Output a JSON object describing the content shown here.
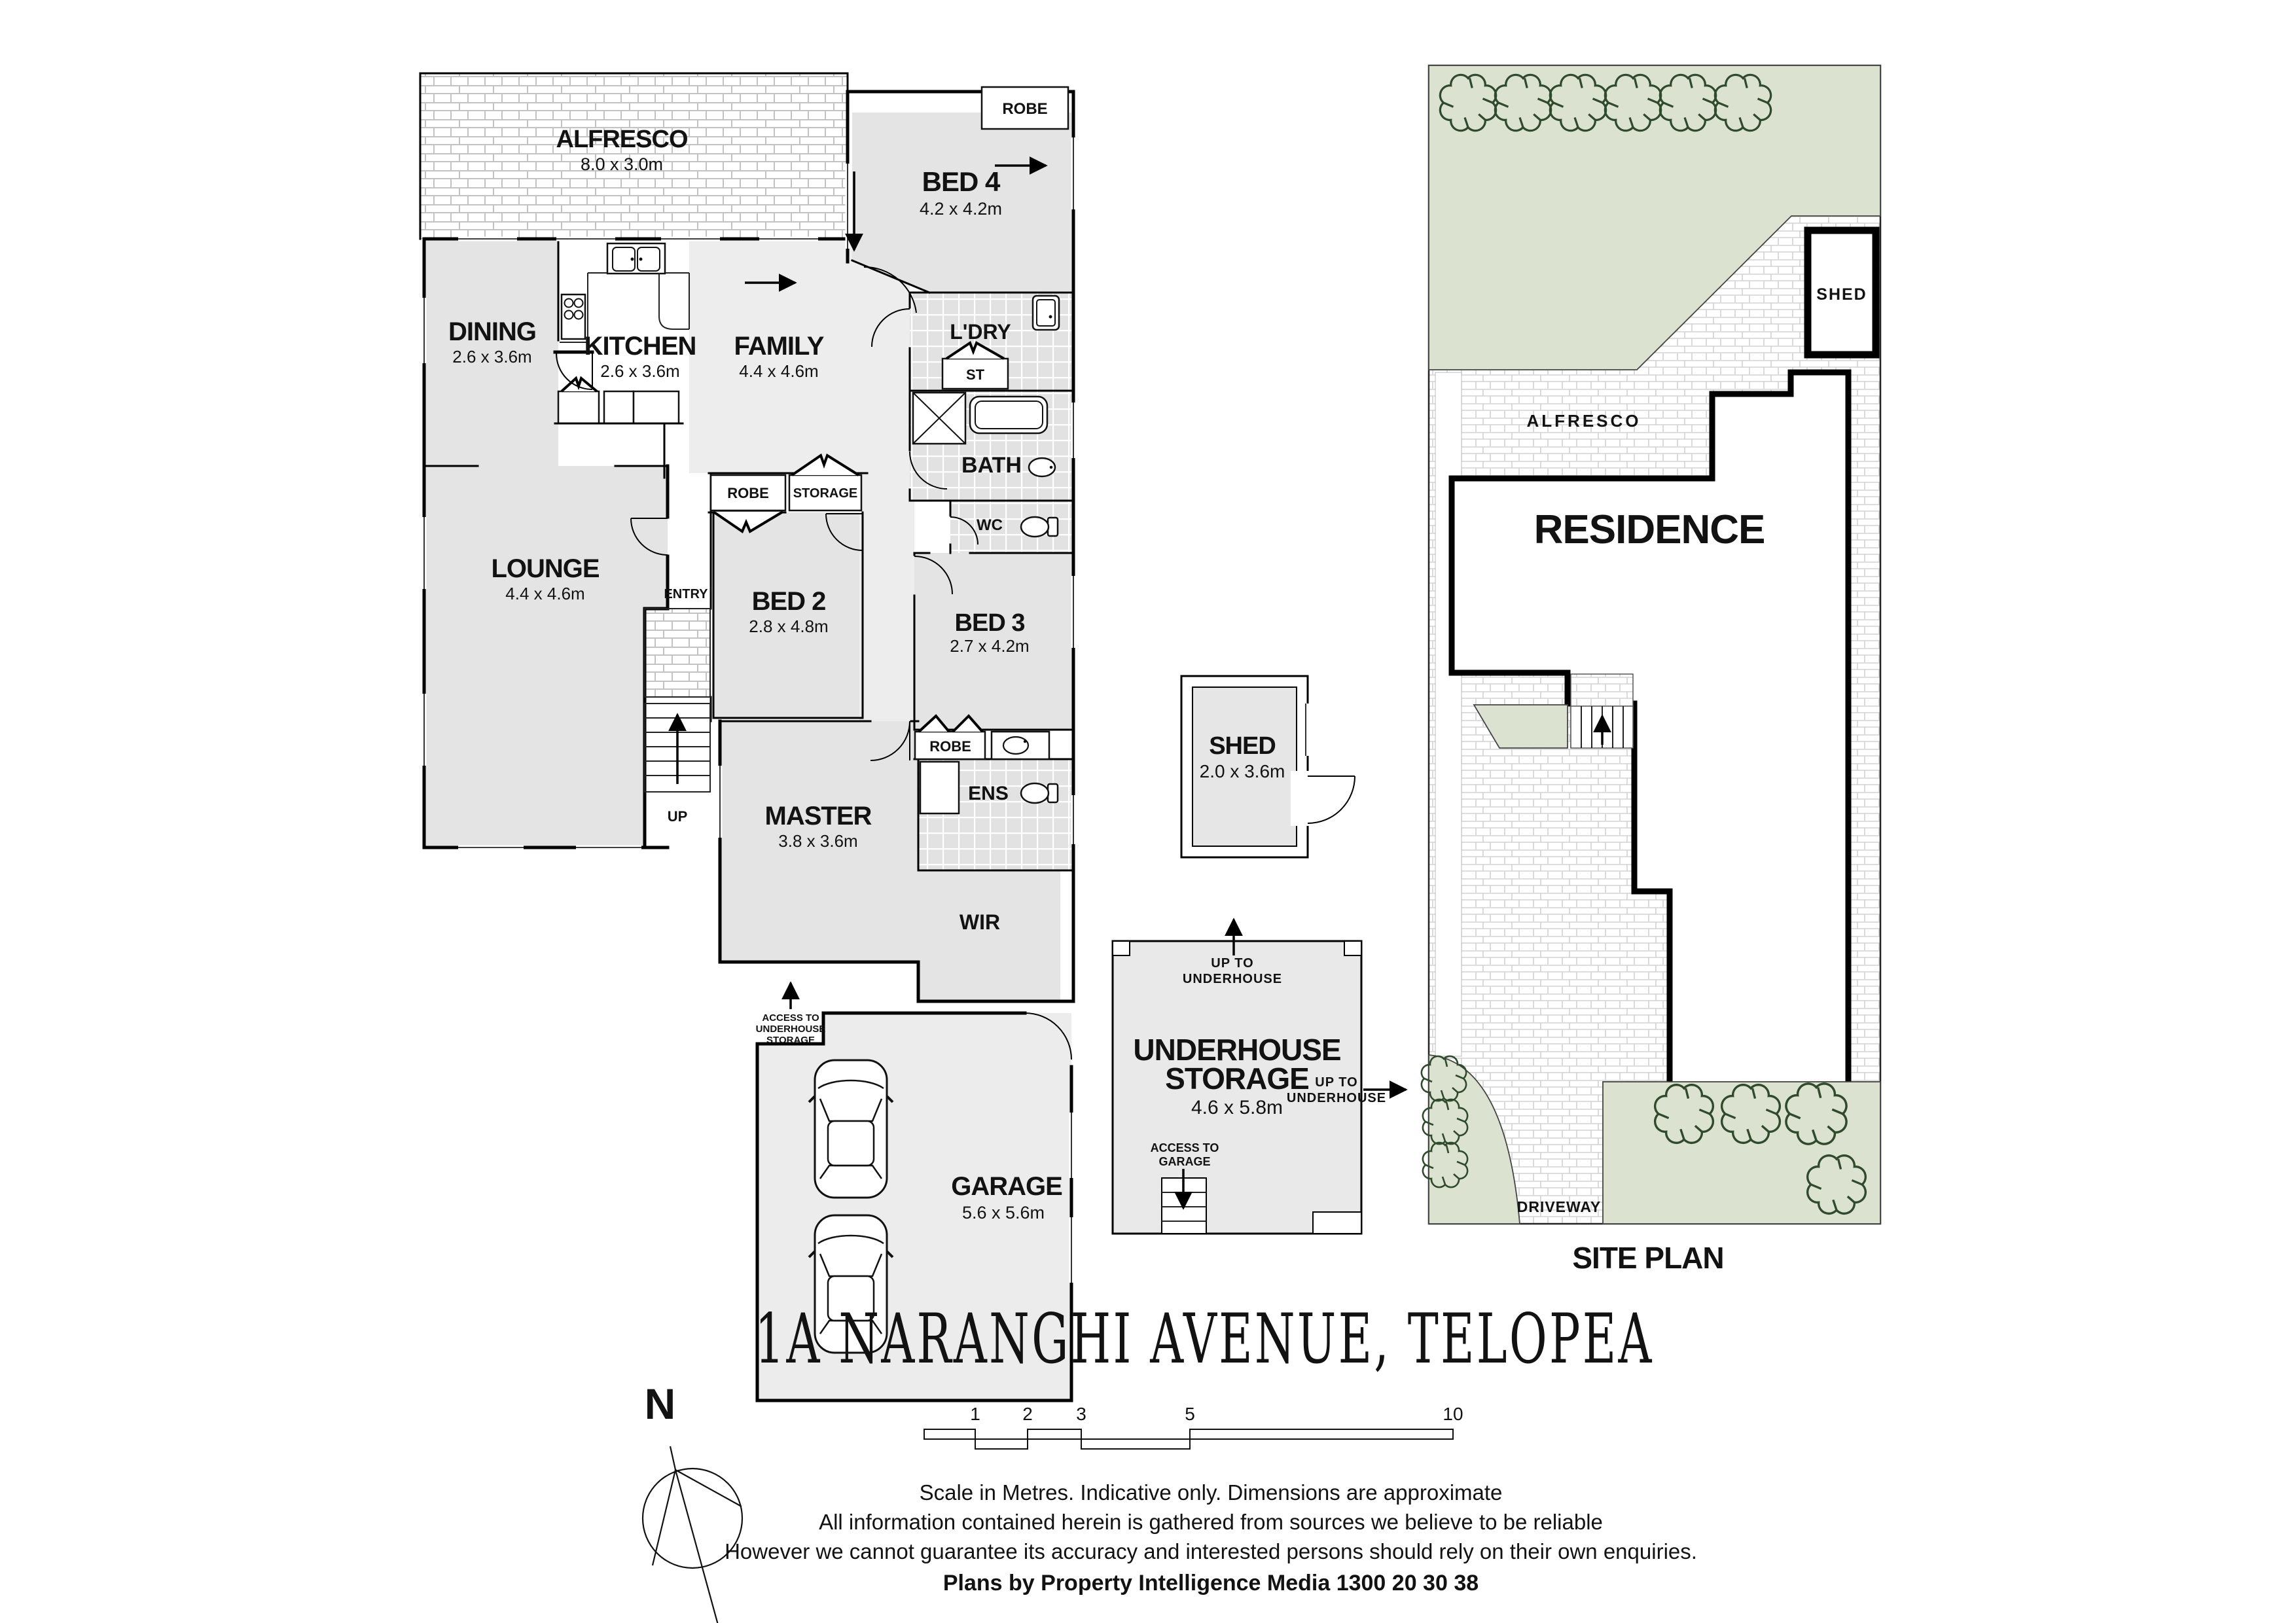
{
  "header": {
    "address": "1A NARANGHI AVENUE, TELOPEA"
  },
  "floorplan": {
    "rooms": {
      "alfresco": {
        "name": "ALFRESCO",
        "dims": "8.0 x 3.0m"
      },
      "bed4": {
        "name": "BED 4",
        "dims": "4.2 x 4.2m"
      },
      "dining": {
        "name": "DINING",
        "dims": "2.6 x 3.6m"
      },
      "kitchen": {
        "name": "KITCHEN",
        "dims": "2.6 x 3.6m"
      },
      "family": {
        "name": "FAMILY",
        "dims": "4.4 x 4.6m"
      },
      "ldry": {
        "name": "L'DRY"
      },
      "bath": {
        "name": "BATH"
      },
      "wc": {
        "name": "WC"
      },
      "lounge": {
        "name": "LOUNGE",
        "dims": "4.4 x 4.6m"
      },
      "bed2": {
        "name": "BED 2",
        "dims": "2.8 x 4.8m"
      },
      "bed3": {
        "name": "BED 3",
        "dims": "2.7 x 4.2m"
      },
      "master": {
        "name": "MASTER",
        "dims": "3.8 x 3.6m"
      },
      "ens": {
        "name": "ENS"
      },
      "wir": {
        "name": "WIR"
      },
      "garage": {
        "name": "GARAGE",
        "dims": "5.6 x 5.6m"
      },
      "shed": {
        "name": "SHED",
        "dims": "2.0 x 3.6m"
      },
      "underhouse": {
        "line1": "UNDERHOUSE",
        "line2": "STORAGE",
        "dims": "4.6 x 5.8m"
      }
    },
    "fixtures": {
      "robe_bed4": "ROBE",
      "robe_bed2": "ROBE",
      "storage": "STORAGE",
      "st": "ST",
      "pantry": "P'TRY",
      "oven": "OV",
      "fridge": "F",
      "entry": "ENTRY",
      "up": "UP",
      "robe_bed3": "ROBE"
    },
    "notes": {
      "access_underhouse": [
        "ACCESS TO",
        "UNDERHOUSE",
        "STORAGE"
      ],
      "up_to_underhouse_top": [
        "UP TO",
        "UNDERHOUSE"
      ],
      "up_to_underhouse_right": [
        "UP TO",
        "UNDERHOUSE"
      ],
      "access_garage": [
        "ACCESS TO",
        "GARAGE"
      ]
    }
  },
  "siteplan": {
    "title": "SITE PLAN",
    "labels": {
      "residence": "RESIDENCE",
      "alfresco": "ALFRESCO",
      "shed": "SHED",
      "driveway": "DRIVEWAY"
    }
  },
  "compass": {
    "north": "N"
  },
  "scalebar": {
    "ticks": [
      "1",
      "2",
      "3",
      "5",
      "10"
    ]
  },
  "footer": {
    "line1": "Scale in Metres. Indicative only. Dimensions are approximate",
    "line2": "All information contained herein is gathered from sources we believe to be reliable",
    "line3": "However we cannot guarantee its accuracy and interested persons should rely on their own enquiries.",
    "credit": "Plans by Property Intelligence Media 1300 20 30 38"
  },
  "colors": {
    "wall": "#000000",
    "room_gray": "#e4e4e4",
    "room_light": "#ededed",
    "tile": "#e2e2e2",
    "brick_line": "#c3c3c3",
    "lawn": "#dbe3d0",
    "tree": "#2f4a2c"
  }
}
